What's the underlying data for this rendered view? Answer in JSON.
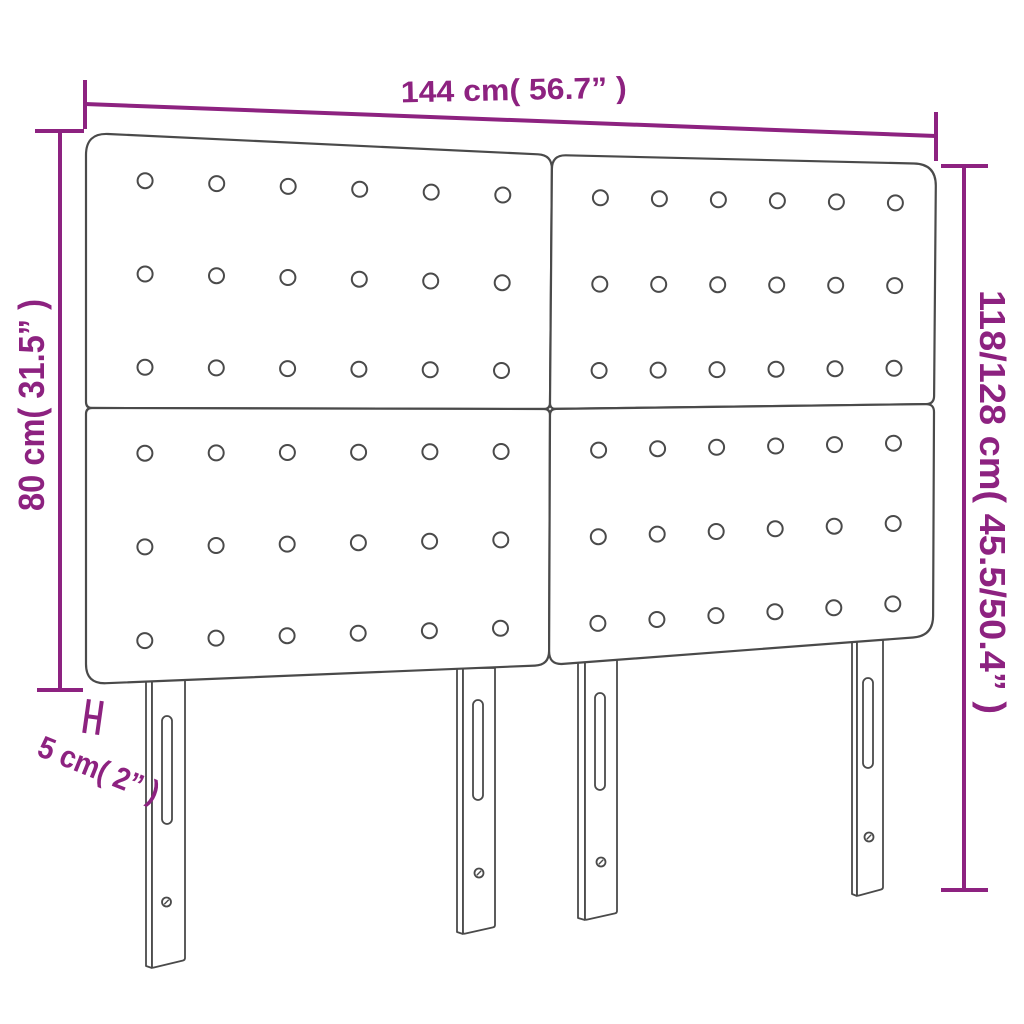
{
  "title": "Headboard dimensions diagram",
  "colors": {
    "dimension": "#8d2280",
    "outline": "#4a4a4a",
    "background": "#ffffff"
  },
  "labels": {
    "width": "144 cm( 56.7” )",
    "panel_height": "80 cm( 31.5” )",
    "total_height": "118/128 cm( 45.5/50.4” )",
    "depth": "5 cm( 2” )"
  },
  "structure": {
    "panel_rows": 2,
    "panel_cols": 2,
    "button_rows_per_panel": 3,
    "button_cols_per_panel": 6,
    "legs": 4
  }
}
